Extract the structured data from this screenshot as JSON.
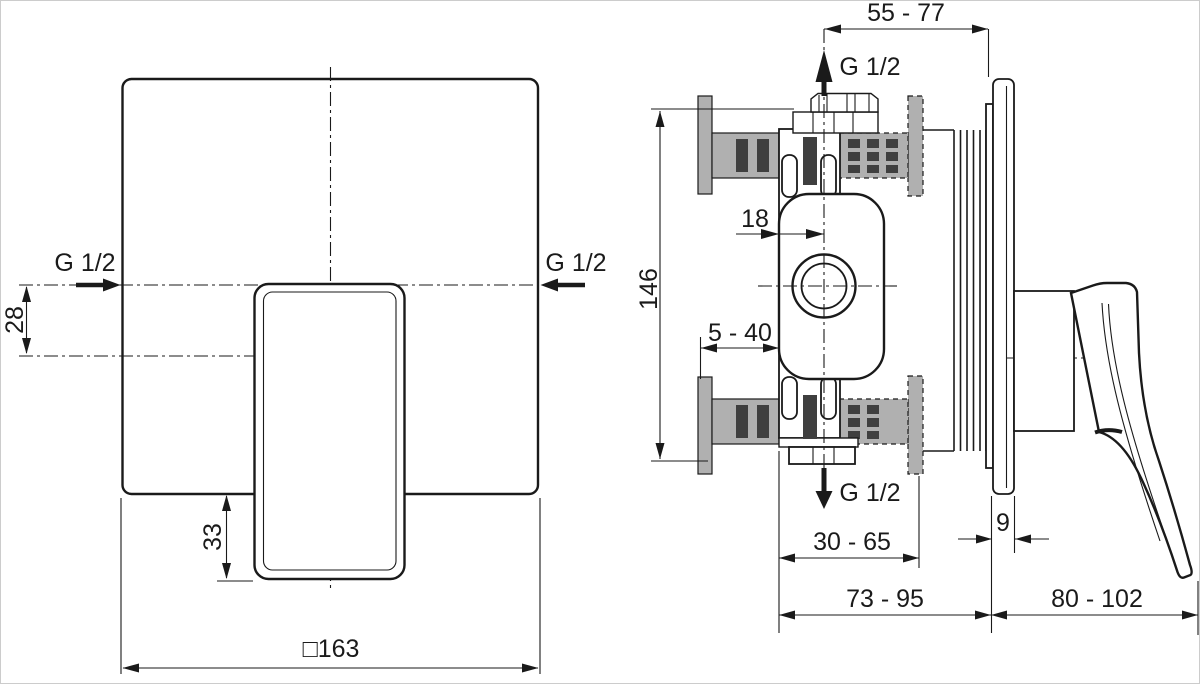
{
  "drawing": {
    "product": "Concealed single-lever shower mixer - installation dimension drawing",
    "views": {
      "front": {
        "inlet_label_left": "G 1/2",
        "inlet_label_right": "G 1/2",
        "dim_inlet_to_handle_axis": "28",
        "dim_handle_below_plate": "33",
        "dim_plate_square": "□163"
      },
      "side": {
        "outlet_label_top": "G 1/2",
        "outlet_label_bottom": "G 1/2",
        "dim_top_connection_depth": "55 - 77",
        "dim_body_height": "146",
        "dim_axis_to_body_face": "18",
        "dim_finished_wall_range": "5 - 40",
        "dim_body_face_to_wall": "30 - 65",
        "dim_plate_thickness": "9",
        "dim_body_face_to_plate": "73 - 95",
        "dim_handle_projection": "80 - 102"
      }
    },
    "colors": {
      "line": "#1a1a1a",
      "wall_fill": "#b0b0b0",
      "anchor_fill": "#3f3f3f",
      "background": "#ffffff"
    }
  }
}
